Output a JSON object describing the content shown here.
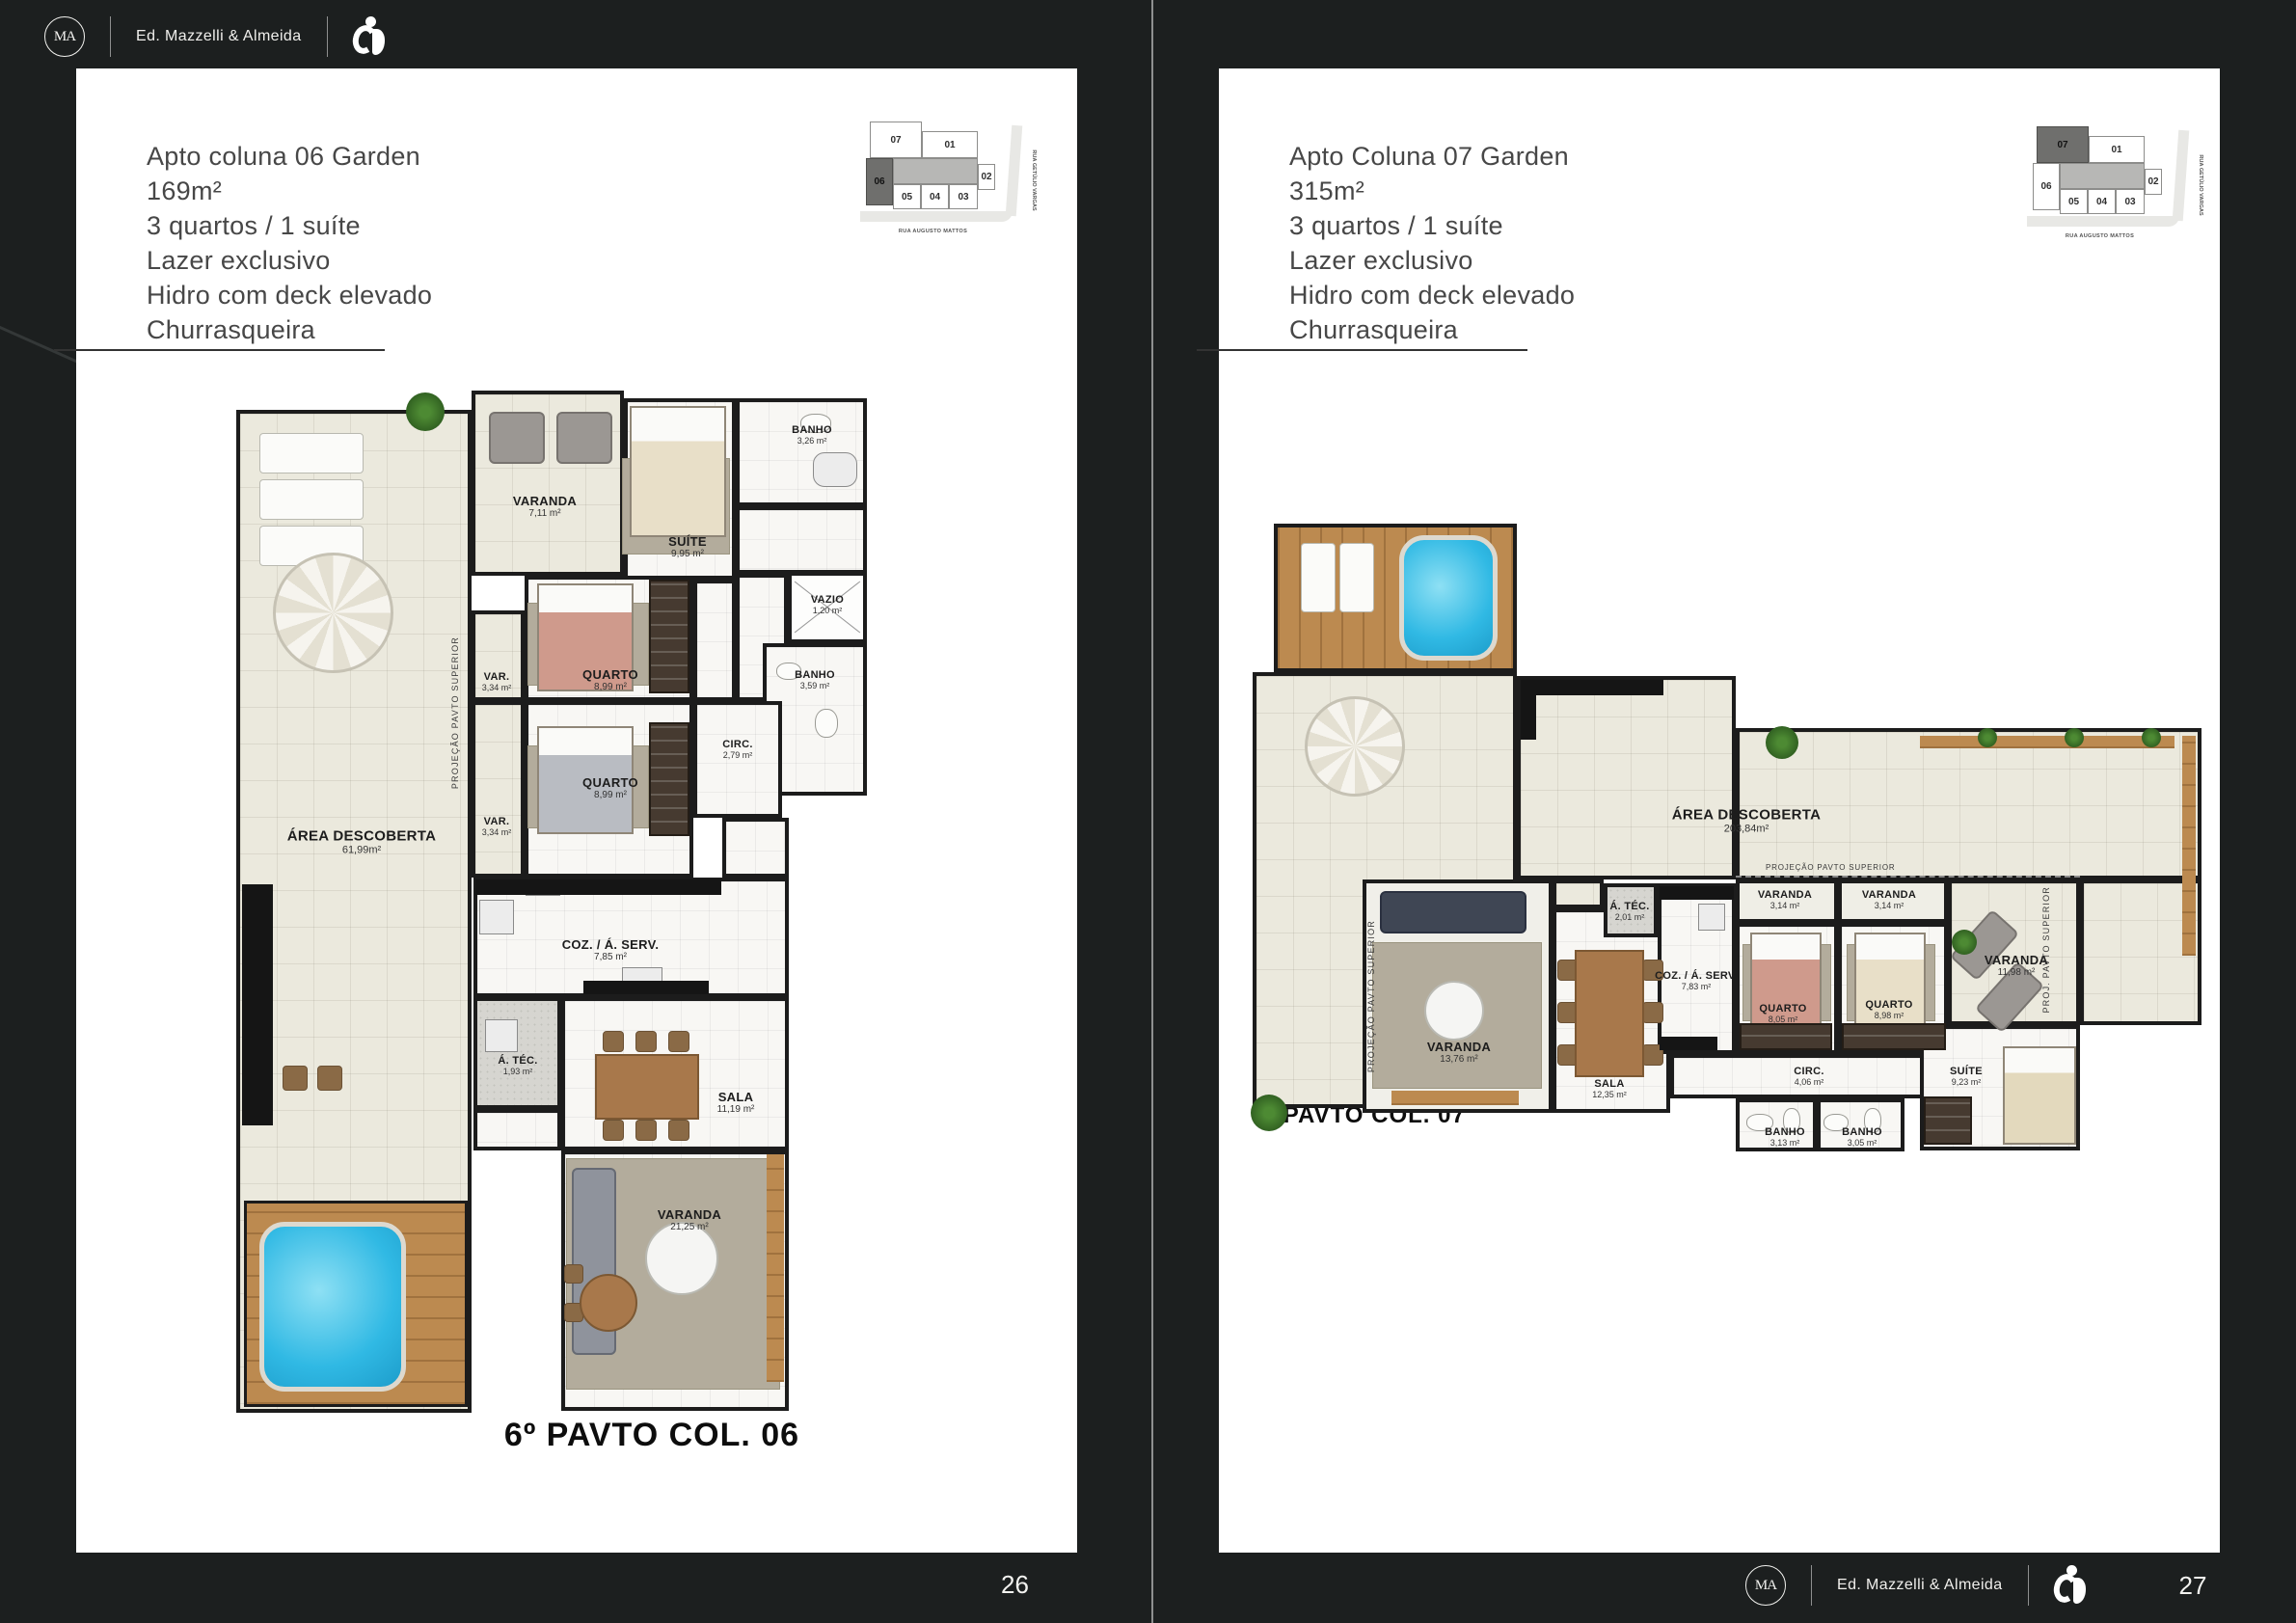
{
  "brand": {
    "name": "Ed. Mazzelli & Almeida",
    "monogram": "MA"
  },
  "page_numbers": {
    "left": "26",
    "right": "27"
  },
  "keyplan": {
    "street_bottom": "RUA AUGUSTO MATTOS",
    "street_right": "RUA GETÚLIO VARGAS",
    "units": {
      "u07": "07",
      "u01": "01",
      "u02": "02",
      "u06": "06",
      "u05": "05",
      "u04": "04",
      "u03": "03"
    }
  },
  "pages": [
    {
      "title_lines": [
        "Apto coluna 06 Garden",
        "169m²",
        "3 quartos / 1 suíte",
        "Lazer exclusivo",
        "Hidro com deck elevado",
        "Churrasqueira"
      ],
      "caption": "6º PAVTO COL. 06",
      "plan": {
        "projection_label": "PROJEÇÃO PAVTO SUPERIOR",
        "rooms": {
          "varanda_top": {
            "name": "VARANDA",
            "area": "7,11 m²"
          },
          "suite": {
            "name": "SUÍTE",
            "area": "9,95 m²"
          },
          "banho_suite": {
            "name": "BANHO",
            "area": "3,26 m²"
          },
          "vazio": {
            "name": "VAZIO",
            "area": "1,20 m²"
          },
          "banho": {
            "name": "BANHO",
            "area": "3,59 m²"
          },
          "circ": {
            "name": "CIRC.",
            "area": "2,79 m²"
          },
          "quarto1": {
            "name": "QUARTO",
            "area": "8,99 m²"
          },
          "quarto2": {
            "name": "QUARTO",
            "area": "8,99 m²"
          },
          "var1": {
            "name": "VAR.",
            "area": "3,34 m²"
          },
          "var2": {
            "name": "VAR.",
            "area": "3,34 m²"
          },
          "area_descoberta": {
            "name": "ÁREA DESCOBERTA",
            "area": "61,99m²"
          },
          "coz": {
            "name": "COZ. / Á. SERV.",
            "area": "7,85 m²"
          },
          "atec": {
            "name": "Á. TÉC.",
            "area": "1,93 m²"
          },
          "sala": {
            "name": "SALA",
            "area": "11,19 m²"
          },
          "varanda_bottom": {
            "name": "VARANDA",
            "area": "21,25 m²"
          }
        }
      }
    },
    {
      "title_lines": [
        "Apto Coluna 07 Garden",
        "315m²",
        "3 quartos / 1 suíte",
        "Lazer exclusivo",
        "Hidro com deck elevado",
        "Churrasqueira"
      ],
      "caption": "6º PAVTO COL. 07",
      "plan": {
        "projection_label": "PROJEÇÃO PAVTO SUPERIOR",
        "projection_label_short": "PROJ. PAVTO SUPERIOR",
        "rooms": {
          "area_descoberta": {
            "name": "ÁREA DESCOBERTA",
            "area": "203,84m²"
          },
          "varanda_main": {
            "name": "VARANDA",
            "area": "13,76 m²"
          },
          "sala": {
            "name": "SALA",
            "area": "12,35 m²"
          },
          "atec": {
            "name": "Á. TÉC.",
            "area": "2,01 m²"
          },
          "coz": {
            "name": "COZ. / Á. SERV.",
            "area": "7,83 m²"
          },
          "varanda1": {
            "name": "VARANDA",
            "area": "3,14 m²"
          },
          "varanda2": {
            "name": "VARANDA",
            "area": "3,14 m²"
          },
          "quarto1": {
            "name": "QUARTO",
            "area": "8,05 m²"
          },
          "quarto2": {
            "name": "QUARTO",
            "area": "8,98 m²"
          },
          "varanda_open": {
            "name": "VARANDA",
            "area": "11,98 m²"
          },
          "circ": {
            "name": "CIRC.",
            "area": "4,06 m²"
          },
          "banho1": {
            "name": "BANHO",
            "area": "3,13 m²"
          },
          "banho2": {
            "name": "BANHO",
            "area": "3,05 m²"
          },
          "suite": {
            "name": "SUÍTE",
            "area": "9,23 m²"
          }
        }
      }
    }
  ]
}
